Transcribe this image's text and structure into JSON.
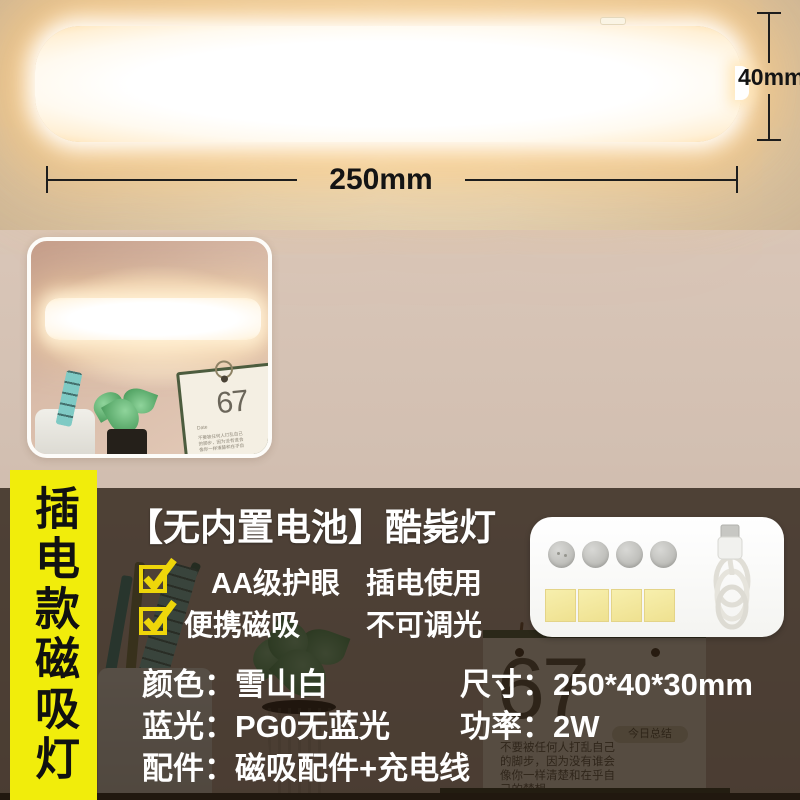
{
  "dimensions": {
    "width_label": "250mm",
    "height_label": "40mm"
  },
  "side_banner": {
    "text": "插电款磁吸灯"
  },
  "info_panel": {
    "title": "【无内置电池】酷毙灯",
    "feature_rows": [
      {
        "left": "AA级护眼",
        "right": "插电使用"
      },
      {
        "left": "便携磁吸",
        "right": "不可调光"
      }
    ],
    "specs_left": [
      {
        "key": "颜色：",
        "value": "雪山白"
      },
      {
        "key": "蓝光：",
        "value": "PG0无蓝光"
      },
      {
        "key": "配件：",
        "value": "磁吸配件+充电线"
      }
    ],
    "specs_right": [
      {
        "key": "尺寸：",
        "value": "250*40*30mm"
      },
      {
        "key": "功率：",
        "value": "2W"
      }
    ]
  },
  "background_scene": {
    "calendar_number": "67",
    "calendar_badge": "今日总结",
    "calendar_note_lines": [
      "不要被任何人打乱自己",
      "的脚步，因为没有谁会",
      "像你一样清楚和在乎自",
      "己的梦想。"
    ],
    "inset_calendar_number": "67",
    "inset_calendar_date_label": "Date"
  },
  "colors": {
    "banner_bg": "#f1ed0b",
    "check_yellow": "#eed60a",
    "overlay": "rgba(33,22,12,0.74)",
    "info_text": "#ffffff",
    "dim_line": "#1d1d1d"
  }
}
